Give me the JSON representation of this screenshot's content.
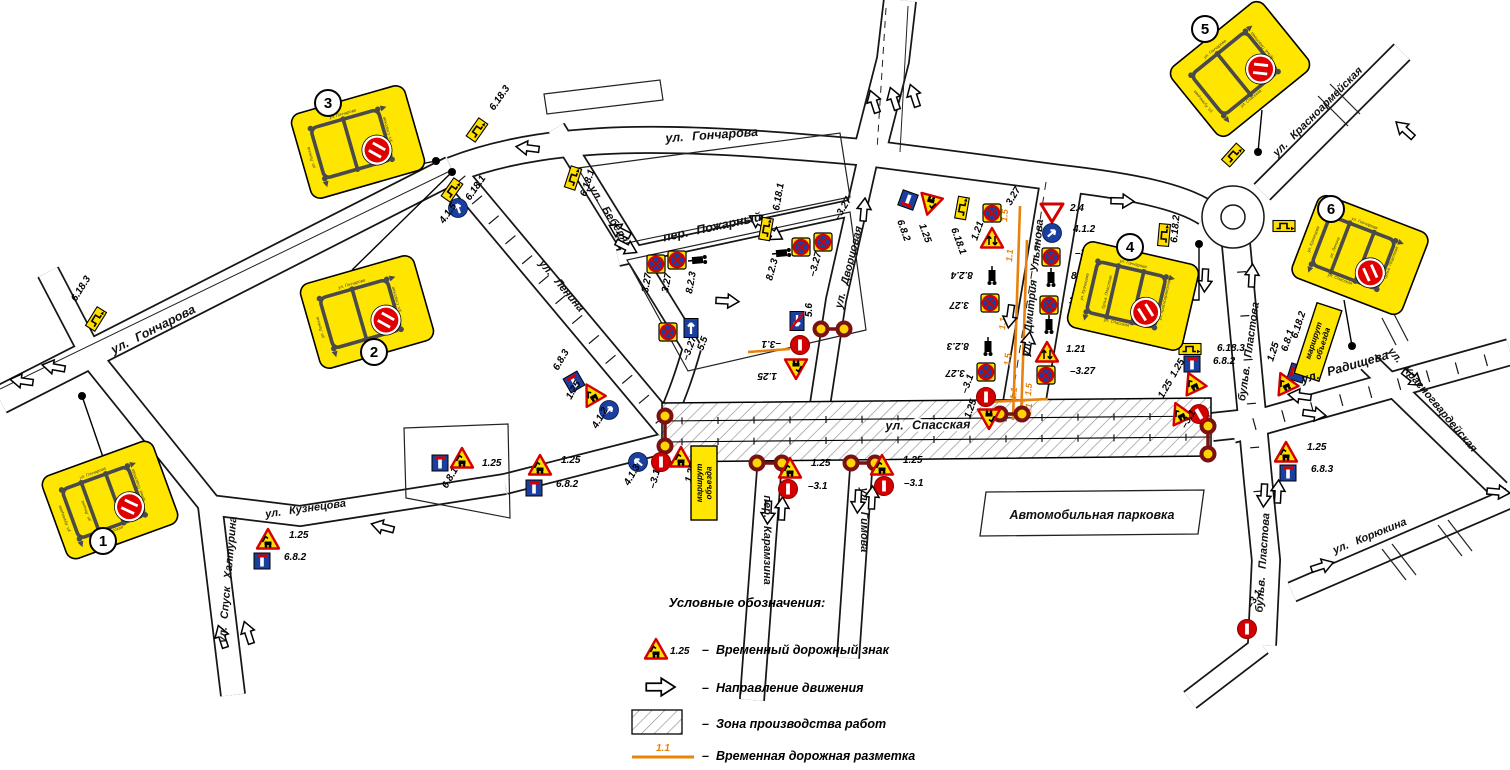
{
  "colors": {
    "sign_yellow": "#FFDE00",
    "board_yellow": "#FFE600",
    "red": "#D40000",
    "dark_red": "#7A1212",
    "blue": "#1B3F9E",
    "orange": "#E8820C",
    "hatch_gray": "#8F8F8F",
    "mini_gray": "#4A4A4A"
  },
  "legend": {
    "title": "Условные обозначения:",
    "items": [
      {
        "symbol": "temp-sign",
        "code": "1.25",
        "label": "Временный дорожный знак"
      },
      {
        "symbol": "direction-arrow",
        "code": "",
        "label": "Направление движения"
      },
      {
        "symbol": "work-zone",
        "code": "",
        "label": "Зона производства работ"
      },
      {
        "symbol": "temp-marking",
        "code": "1.1",
        "label": "Временная дорожная разметка"
      }
    ]
  },
  "parking": {
    "label": "Автомобильная парковка"
  },
  "detour_board_text": "маршрут объезда",
  "streets": [
    {
      "label": "ул. Гончарова"
    },
    {
      "label": "ул. Гончарова"
    },
    {
      "label": "ул. Бебеля"
    },
    {
      "label": "ул. Ленина"
    },
    {
      "label": "пер. Пожарный"
    },
    {
      "label": "ул. Дворцовая"
    },
    {
      "label": "ул. Дмитрия Ульянова"
    },
    {
      "label": "ул. Спасская"
    },
    {
      "label": "ул. Кузнецова"
    },
    {
      "label": "ул. Спуск Халтурина"
    },
    {
      "label": "пер. Карамзина"
    },
    {
      "label": "ул. Гимова"
    },
    {
      "label": "бульв. Пластова"
    },
    {
      "label": "бульв. Пластова"
    },
    {
      "label": "ул. Радищева"
    },
    {
      "label": "ул. Красноармейская"
    },
    {
      "label": "ул. Красногвардейская"
    },
    {
      "label": "ул. Корюкина"
    }
  ],
  "boards": [
    {
      "num": "1",
      "x": 110,
      "y": 500,
      "r": -20,
      "cx": 103,
      "cy": 541,
      "v": 2,
      "streets": [
        "ул. Гончарова",
        "ул. Кузнецова",
        "ул. Ленина",
        "бульв. Пластова",
        "ул. Спасская"
      ]
    },
    {
      "num": "2",
      "x": 367,
      "y": 312,
      "r": -16,
      "cx": 374,
      "cy": 352,
      "v": 1,
      "streets": [
        "ул. Гончарова",
        "ул. Ленина",
        "",
        "ул. Спасская",
        ""
      ]
    },
    {
      "num": "3",
      "x": 358,
      "y": 142,
      "r": -16,
      "cx": 328,
      "cy": 103,
      "v": 1,
      "streets": [
        "ул. Гончарова",
        "ул. Ленина",
        "",
        "ул. Спасская",
        ""
      ]
    },
    {
      "num": "4",
      "x": 1133,
      "y": 296,
      "r": 13,
      "cx": 1130,
      "cy": 247,
      "v": 2,
      "streets": [
        "ул. Гончарова",
        "ул. Кузнецова",
        "бульв. Пластова",
        "ул. Красноармейская",
        "ул. Спасская"
      ]
    },
    {
      "num": "5",
      "x": 1240,
      "y": 69,
      "r": -39,
      "cx": 1205,
      "cy": 29,
      "v": 1,
      "streets": [
        "ул. Гончарова",
        "ул. Кузнецова",
        "",
        "бульв. Пластова",
        "ул. Спасская"
      ]
    },
    {
      "num": "6",
      "x": 1360,
      "y": 255,
      "r": 21,
      "cx": 1331,
      "cy": 209,
      "v": 2,
      "streets": [
        "ул. Гончарова",
        "ул. Кузнецова",
        "ул. Ленина",
        "бульв. Пластова",
        "ул. Спасская"
      ]
    }
  ],
  "leaders": [
    {
      "pts": "105,463 82,396",
      "dx": 82,
      "dy": 396
    },
    {
      "pts": "352,270 452,172",
      "dx": 452,
      "dy": 172
    },
    {
      "pts": "400,168 436,161",
      "dx": 436,
      "dy": 161
    },
    {
      "pts": "1186,300 1199,300 1199,244",
      "dx": 1199,
      "dy": 244
    },
    {
      "pts": "1262,110 1258,152",
      "dx": 1258,
      "dy": 152
    },
    {
      "pts": "1344,300 1352,346",
      "dx": 1352,
      "dy": 346
    }
  ],
  "detour_boards": [
    {
      "x": 704,
      "y": 483,
      "r": -90
    },
    {
      "x": 1318,
      "y": 342,
      "r": -72
    }
  ],
  "marking": {
    "lines": [
      [
        1020,
        206,
        1013,
        420
      ],
      [
        1027,
        240,
        1021,
        420
      ],
      [
        988,
        402,
        1048,
        399
      ],
      [
        748,
        352,
        790,
        349
      ]
    ],
    "labels": [
      [
        "1.5",
        1007,
        222
      ],
      [
        "1.1",
        1012,
        262
      ],
      [
        "1.1",
        1005,
        330
      ],
      [
        "1.5",
        1010,
        366
      ],
      [
        "1.1",
        1016,
        400
      ],
      [
        "1.5",
        1031,
        396
      ],
      [
        "1.1",
        1031,
        416
      ]
    ]
  },
  "arrows": [
    [
      22,
      381,
      188
    ],
    [
      54,
      367,
      190
    ],
    [
      222,
      637,
      252
    ],
    [
      248,
      633,
      252
    ],
    [
      383,
      527,
      195
    ],
    [
      528,
      148,
      187
    ],
    [
      620,
      231,
      207
    ],
    [
      626,
      247,
      27
    ],
    [
      760,
      222,
      210
    ],
    [
      772,
      233,
      30
    ],
    [
      727,
      301,
      3
    ],
    [
      864,
      210,
      -85
    ],
    [
      874,
      102,
      252
    ],
    [
      894,
      99,
      252
    ],
    [
      914,
      96,
      252
    ],
    [
      1122,
      201,
      2
    ],
    [
      1010,
      316,
      98
    ],
    [
      1028,
      344,
      -82
    ],
    [
      1205,
      280,
      93
    ],
    [
      1252,
      276,
      -87
    ],
    [
      1300,
      396,
      188
    ],
    [
      1314,
      414,
      8
    ],
    [
      1412,
      378,
      38
    ],
    [
      1405,
      130,
      222
    ],
    [
      1498,
      492,
      5
    ],
    [
      1264,
      495,
      93
    ],
    [
      1278,
      492,
      -87
    ],
    [
      768,
      512,
      93
    ],
    [
      782,
      509,
      -87
    ],
    [
      858,
      501,
      93
    ],
    [
      872,
      498,
      -87
    ],
    [
      1322,
      566,
      -18
    ]
  ],
  "signals": [
    [
      665,
      416,
      665,
      446
    ],
    [
      757,
      463,
      782,
      463
    ],
    [
      851,
      463,
      875,
      463
    ],
    [
      821,
      329,
      844,
      329
    ],
    [
      1000,
      414,
      1022,
      414
    ],
    [
      1208,
      426,
      1208,
      454
    ]
  ],
  "signs": [
    {
      "t": "detour",
      "code": "6.18.3",
      "x": 96,
      "y": 319,
      "r": -58,
      "lbl": "6.18.3",
      "lx": 76,
      "ly": 302,
      "lr": -58
    },
    {
      "t": "detour",
      "code": "6.18.3",
      "x": 477,
      "y": 130,
      "r": -55,
      "lbl": "6.18.3",
      "lx": 494,
      "ly": 111,
      "lr": -55
    },
    {
      "t": "detour",
      "code": "6.18.1",
      "x": 452,
      "y": 190,
      "r": -55,
      "lbl": "6.18.1",
      "lx": 470,
      "ly": 201,
      "lr": -55
    },
    {
      "t": "bluearrow",
      "code": "4.1.5",
      "x": 458,
      "y": 208,
      "r": 0,
      "lbl": "4.1.5",
      "lx": 444,
      "ly": 224,
      "lr": -55
    },
    {
      "t": "detour",
      "code": "6.18.1",
      "x": 573,
      "y": 178,
      "r": -72,
      "lbl": "6.18.1",
      "lx": 586,
      "ly": 197,
      "lr": -72
    },
    {
      "t": "nostop",
      "code": "3.27",
      "x": 656,
      "y": 264,
      "r": 0,
      "lbl": "3.27",
      "lx": 648,
      "ly": 293,
      "lr": -80
    },
    {
      "t": "nostop",
      "code": "3.27",
      "x": 677,
      "y": 260,
      "r": 0,
      "lbl": "3.27",
      "lx": 668,
      "ly": 293,
      "lr": -80
    },
    {
      "t": "truck",
      "code": "8.2.3",
      "x": 699,
      "y": 260,
      "r": -95,
      "lbl": "8.2.3",
      "lx": 692,
      "ly": 294,
      "lr": -80
    },
    {
      "t": "detour",
      "code": "6.18.1",
      "x": 766,
      "y": 229,
      "r": -80,
      "lbl": "6.18.1",
      "lx": 779,
      "ly": 211,
      "lr": -80
    },
    {
      "t": "truck",
      "code": "8.2.3",
      "x": 783,
      "y": 253,
      "r": -95,
      "lbl": "8.2.3",
      "lx": 772,
      "ly": 281,
      "lr": -75
    },
    {
      "t": "nostop",
      "code": "3.27",
      "x": 801,
      "y": 247,
      "r": 0,
      "lbl": "–3.27",
      "lx": 815,
      "ly": 277,
      "lr": -75
    },
    {
      "t": "nostop",
      "code": "3.27",
      "x": 823,
      "y": 242,
      "r": 0,
      "lbl": "–3.27",
      "lx": 839,
      "ly": 221,
      "lr": -60
    },
    {
      "t": "nostop",
      "code": "3.27",
      "x": 668,
      "y": 332,
      "r": 0,
      "lbl": "–3.27",
      "lx": 688,
      "ly": 361,
      "lr": -70
    },
    {
      "t": "oneway",
      "code": "5.5",
      "x": 691,
      "y": 328,
      "r": 0,
      "lbl": "5.5",
      "lx": 703,
      "ly": 351,
      "lr": -70
    },
    {
      "t": "deadend",
      "code": "6.8.3",
      "x": 574,
      "y": 382,
      "r": -30,
      "lbl": "6.8.3",
      "lx": 558,
      "ly": 371,
      "lr": -60
    },
    {
      "t": "t125",
      "code": "1.25",
      "x": 592,
      "y": 394,
      "r": -30,
      "lbl": "1.25",
      "lx": 571,
      "ly": 400,
      "lr": -60
    },
    {
      "t": "bluearrow",
      "code": "4.1.2",
      "x": 609,
      "y": 410,
      "r": 0,
      "lbl": "4.1.2",
      "lx": 597,
      "ly": 429,
      "lr": -60
    },
    {
      "t": "deadend",
      "code": "6.8.1",
      "x": 440,
      "y": 463,
      "r": 0,
      "lbl": "6.8.1",
      "lx": 447,
      "ly": 489,
      "lr": -60
    },
    {
      "t": "t125",
      "code": "1.25",
      "x": 462,
      "y": 459,
      "r": 0,
      "lbl": "1.25",
      "lx": 482,
      "ly": 466,
      "lr": 0
    },
    {
      "t": "t125",
      "code": "1.25",
      "x": 540,
      "y": 466,
      "r": 0,
      "lbl": "1.25",
      "lx": 561,
      "ly": 463,
      "lr": 0
    },
    {
      "t": "deadend",
      "code": "6.8.2",
      "x": 534,
      "y": 488,
      "r": 0,
      "lbl": "6.8.2",
      "lx": 556,
      "ly": 487,
      "lr": 0
    },
    {
      "t": "bluearrow",
      "code": "4.1.3",
      "x": 638,
      "y": 462,
      "r": 0,
      "lbl": "4.1.3",
      "lx": 629,
      "ly": 486,
      "lr": -60
    },
    {
      "t": "noentry",
      "code": "3.1",
      "x": 661,
      "y": 462,
      "r": 90,
      "lbl": "–3.1",
      "lx": 655,
      "ly": 489,
      "lr": -75
    },
    {
      "t": "t125",
      "code": "1.25",
      "x": 681,
      "y": 458,
      "r": 0,
      "lbl": "1.25",
      "lx": 691,
      "ly": 483,
      "lr": -75
    },
    {
      "t": "t125",
      "code": "1.25",
      "x": 268,
      "y": 540,
      "r": 0,
      "lbl": "1.25",
      "lx": 289,
      "ly": 538,
      "lr": 0
    },
    {
      "t": "deadend",
      "code": "6.8.2",
      "x": 262,
      "y": 561,
      "r": 0,
      "lbl": "6.8.2",
      "lx": 284,
      "ly": 560,
      "lr": 0
    },
    {
      "t": "t125",
      "code": "1.25",
      "x": 790,
      "y": 469,
      "r": 0,
      "lbl": "1.25",
      "lx": 811,
      "ly": 466,
      "lr": 0
    },
    {
      "t": "noentry",
      "code": "3.1",
      "x": 788,
      "y": 489,
      "r": 90,
      "lbl": "–3.1",
      "lx": 808,
      "ly": 489,
      "lr": 0
    },
    {
      "t": "t125",
      "code": "1.25",
      "x": 882,
      "y": 466,
      "r": 0,
      "lbl": "1.25",
      "lx": 903,
      "ly": 463,
      "lr": 0
    },
    {
      "t": "noentry",
      "code": "3.1",
      "x": 884,
      "y": 486,
      "r": 90,
      "lbl": "–3.1",
      "lx": 904,
      "ly": 486,
      "lr": 0
    },
    {
      "t": "onewayend",
      "code": "5.6",
      "x": 797,
      "y": 321,
      "r": 180,
      "lbl": "5.6",
      "lx": 812,
      "ly": 317,
      "lr": -90
    },
    {
      "t": "noentry",
      "code": "3.1",
      "x": 800,
      "y": 345,
      "r": 90,
      "lbl": "–3.1",
      "lx": 781,
      "ly": 341,
      "lr": 180
    },
    {
      "t": "t125",
      "code": "1.25",
      "x": 796,
      "y": 368,
      "r": 180,
      "lbl": "1.25",
      "lx": 777,
      "ly": 373,
      "lr": 180
    },
    {
      "t": "deadend",
      "code": "6.8.2",
      "x": 908,
      "y": 200,
      "r": 200,
      "lbl": "6.8.2",
      "lx": 897,
      "ly": 221,
      "lr": 70
    },
    {
      "t": "t125",
      "code": "1.25",
      "x": 930,
      "y": 204,
      "r": 195,
      "lbl": "1.25",
      "lx": 919,
      "ly": 225,
      "lr": 70
    },
    {
      "t": "detour",
      "code": "6.18.1",
      "x": 962,
      "y": 208,
      "r": -80,
      "lbl": "6.18.1",
      "lx": 951,
      "ly": 229,
      "lr": 70
    },
    {
      "t": "nostop",
      "code": "3.27",
      "x": 992,
      "y": 213,
      "r": 0,
      "lbl": "3.27",
      "lx": 1011,
      "ly": 206,
      "lr": -60
    },
    {
      "t": "t121",
      "code": "1.21",
      "x": 992,
      "y": 239,
      "r": 0,
      "lbl": "1.21",
      "lx": 977,
      "ly": 241,
      "lr": -70
    },
    {
      "t": "truck",
      "code": "8.2.4",
      "x": 992,
      "y": 277,
      "r": 0,
      "lbl": "8.2.4",
      "lx": 973,
      "ly": 272,
      "lr": 180
    },
    {
      "t": "nostop",
      "code": "3.27",
      "x": 990,
      "y": 303,
      "r": 180,
      "lbl": "3.27",
      "lx": 969,
      "ly": 302,
      "lr": 180
    },
    {
      "t": "truck",
      "code": "8.2.3",
      "x": 988,
      "y": 348,
      "r": 0,
      "lbl": "8.2.3",
      "lx": 969,
      "ly": 343,
      "lr": 180
    },
    {
      "t": "nostop",
      "code": "3.27",
      "x": 986,
      "y": 372,
      "r": 180,
      "lbl": "3.27",
      "lx": 965,
      "ly": 370,
      "lr": 180
    },
    {
      "t": "noentry",
      "code": "3.1",
      "x": 986,
      "y": 397,
      "r": 90,
      "lbl": "–3.1",
      "lx": 967,
      "ly": 394,
      "lr": -70
    },
    {
      "t": "t125",
      "code": "1.25",
      "x": 989,
      "y": 418,
      "r": 180,
      "lbl": "1.25",
      "lx": 970,
      "ly": 419,
      "lr": -70
    },
    {
      "t": "giveway",
      "code": "2.4",
      "x": 1052,
      "y": 212,
      "r": 0,
      "lbl": "2.4",
      "lx": 1070,
      "ly": 211,
      "lr": 0
    },
    {
      "t": "bluearrow",
      "code": "4.1.2",
      "x": 1052,
      "y": 233,
      "r": 0,
      "lbl": "4.1.2",
      "lx": 1073,
      "ly": 232,
      "lr": 0
    },
    {
      "t": "nostop",
      "code": "3.27",
      "x": 1051,
      "y": 257,
      "r": 0,
      "lbl": "–3.27",
      "lx": 1075,
      "ly": 256,
      "lr": 0
    },
    {
      "t": "truck",
      "code": "8.2.3",
      "x": 1051,
      "y": 279,
      "r": 0,
      "lbl": "8.2.3",
      "lx": 1071,
      "ly": 279,
      "lr": 0
    },
    {
      "t": "nostop",
      "code": "3.27",
      "x": 1049,
      "y": 305,
      "r": 0,
      "lbl": "3.27",
      "lx": 1069,
      "ly": 304,
      "lr": 0
    },
    {
      "t": "truck",
      "code": "8.2.4",
      "x": 1049,
      "y": 326,
      "r": 0,
      "lbl": "8.2.4",
      "lx": 1069,
      "ly": 326,
      "lr": 0
    },
    {
      "t": "t121",
      "code": "1.21",
      "x": 1047,
      "y": 353,
      "r": 0,
      "lbl": "1.21",
      "lx": 1066,
      "ly": 352,
      "lr": 0
    },
    {
      "t": "nostop",
      "code": "3.27",
      "x": 1046,
      "y": 375,
      "r": 0,
      "lbl": "–3.27",
      "lx": 1070,
      "ly": 374,
      "lr": 0
    },
    {
      "t": "detour",
      "code": "6.18.2",
      "x": 1164,
      "y": 235,
      "r": -85,
      "lbl": "6.18.2",
      "lx": 1177,
      "ly": 243,
      "lr": -85
    },
    {
      "t": "detour",
      "code": "6.18.3",
      "x": 1190,
      "y": 349,
      "r": 0,
      "lbl": "6.18.3",
      "lx": 1217,
      "ly": 351,
      "lr": 0
    },
    {
      "t": "deadend",
      "code": "6.8.2",
      "x": 1192,
      "y": 364,
      "r": 0,
      "lbl": "6.8.2",
      "lx": 1213,
      "ly": 364,
      "lr": 0
    },
    {
      "t": "t125",
      "code": "1.25",
      "x": 1193,
      "y": 383,
      "r": -25,
      "lbl": "1.25",
      "lx": 1175,
      "ly": 378,
      "lr": -60
    },
    {
      "t": "t125",
      "code": "1.25",
      "x": 1180,
      "y": 413,
      "r": -25,
      "lbl": "1.25",
      "lx": 1163,
      "ly": 399,
      "lr": -60
    },
    {
      "t": "noentry",
      "code": "3.1",
      "x": 1199,
      "y": 414,
      "r": 60,
      "lbl": "–3.1",
      "lx": 1186,
      "ly": 429,
      "lr": -60
    },
    {
      "t": "detour",
      "code": "6.18.1",
      "x": 1233,
      "y": 155,
      "r": -48,
      "lbl": "6.18.1",
      "lx": 1221,
      "ly": 135,
      "lr": -48
    },
    {
      "t": "detour",
      "code": "6.18.3",
      "x": 1284,
      "y": 226,
      "r": 0,
      "lbl": "6.18.3",
      "lx": 1309,
      "ly": 225,
      "lr": 0
    },
    {
      "t": "detour",
      "code": "6.18.2",
      "x": 1307,
      "y": 360,
      "r": -72,
      "lbl": "6.18.2",
      "lx": 1297,
      "ly": 339,
      "lr": -72
    },
    {
      "t": "deadend",
      "code": "6.8.1",
      "x": 1297,
      "y": 373,
      "r": -72,
      "lbl": "6.8.1",
      "lx": 1287,
      "ly": 352,
      "lr": -72
    },
    {
      "t": "t125",
      "code": "1.25",
      "x": 1285,
      "y": 383,
      "r": -25,
      "lbl": "1.25",
      "lx": 1273,
      "ly": 362,
      "lr": -72
    },
    {
      "t": "t125",
      "code": "1.25",
      "x": 1286,
      "y": 453,
      "r": 0,
      "lbl": "1.25",
      "lx": 1307,
      "ly": 450,
      "lr": 0
    },
    {
      "t": "deadend",
      "code": "6.8.3",
      "x": 1288,
      "y": 473,
      "r": 0,
      "lbl": "6.8.3",
      "lx": 1311,
      "ly": 472,
      "lr": 0
    },
    {
      "t": "noentry",
      "code": "3.1",
      "x": 1247,
      "y": 629,
      "r": 90,
      "lbl": "–3.1",
      "lx": 1252,
      "ly": 609,
      "lr": -60
    }
  ]
}
